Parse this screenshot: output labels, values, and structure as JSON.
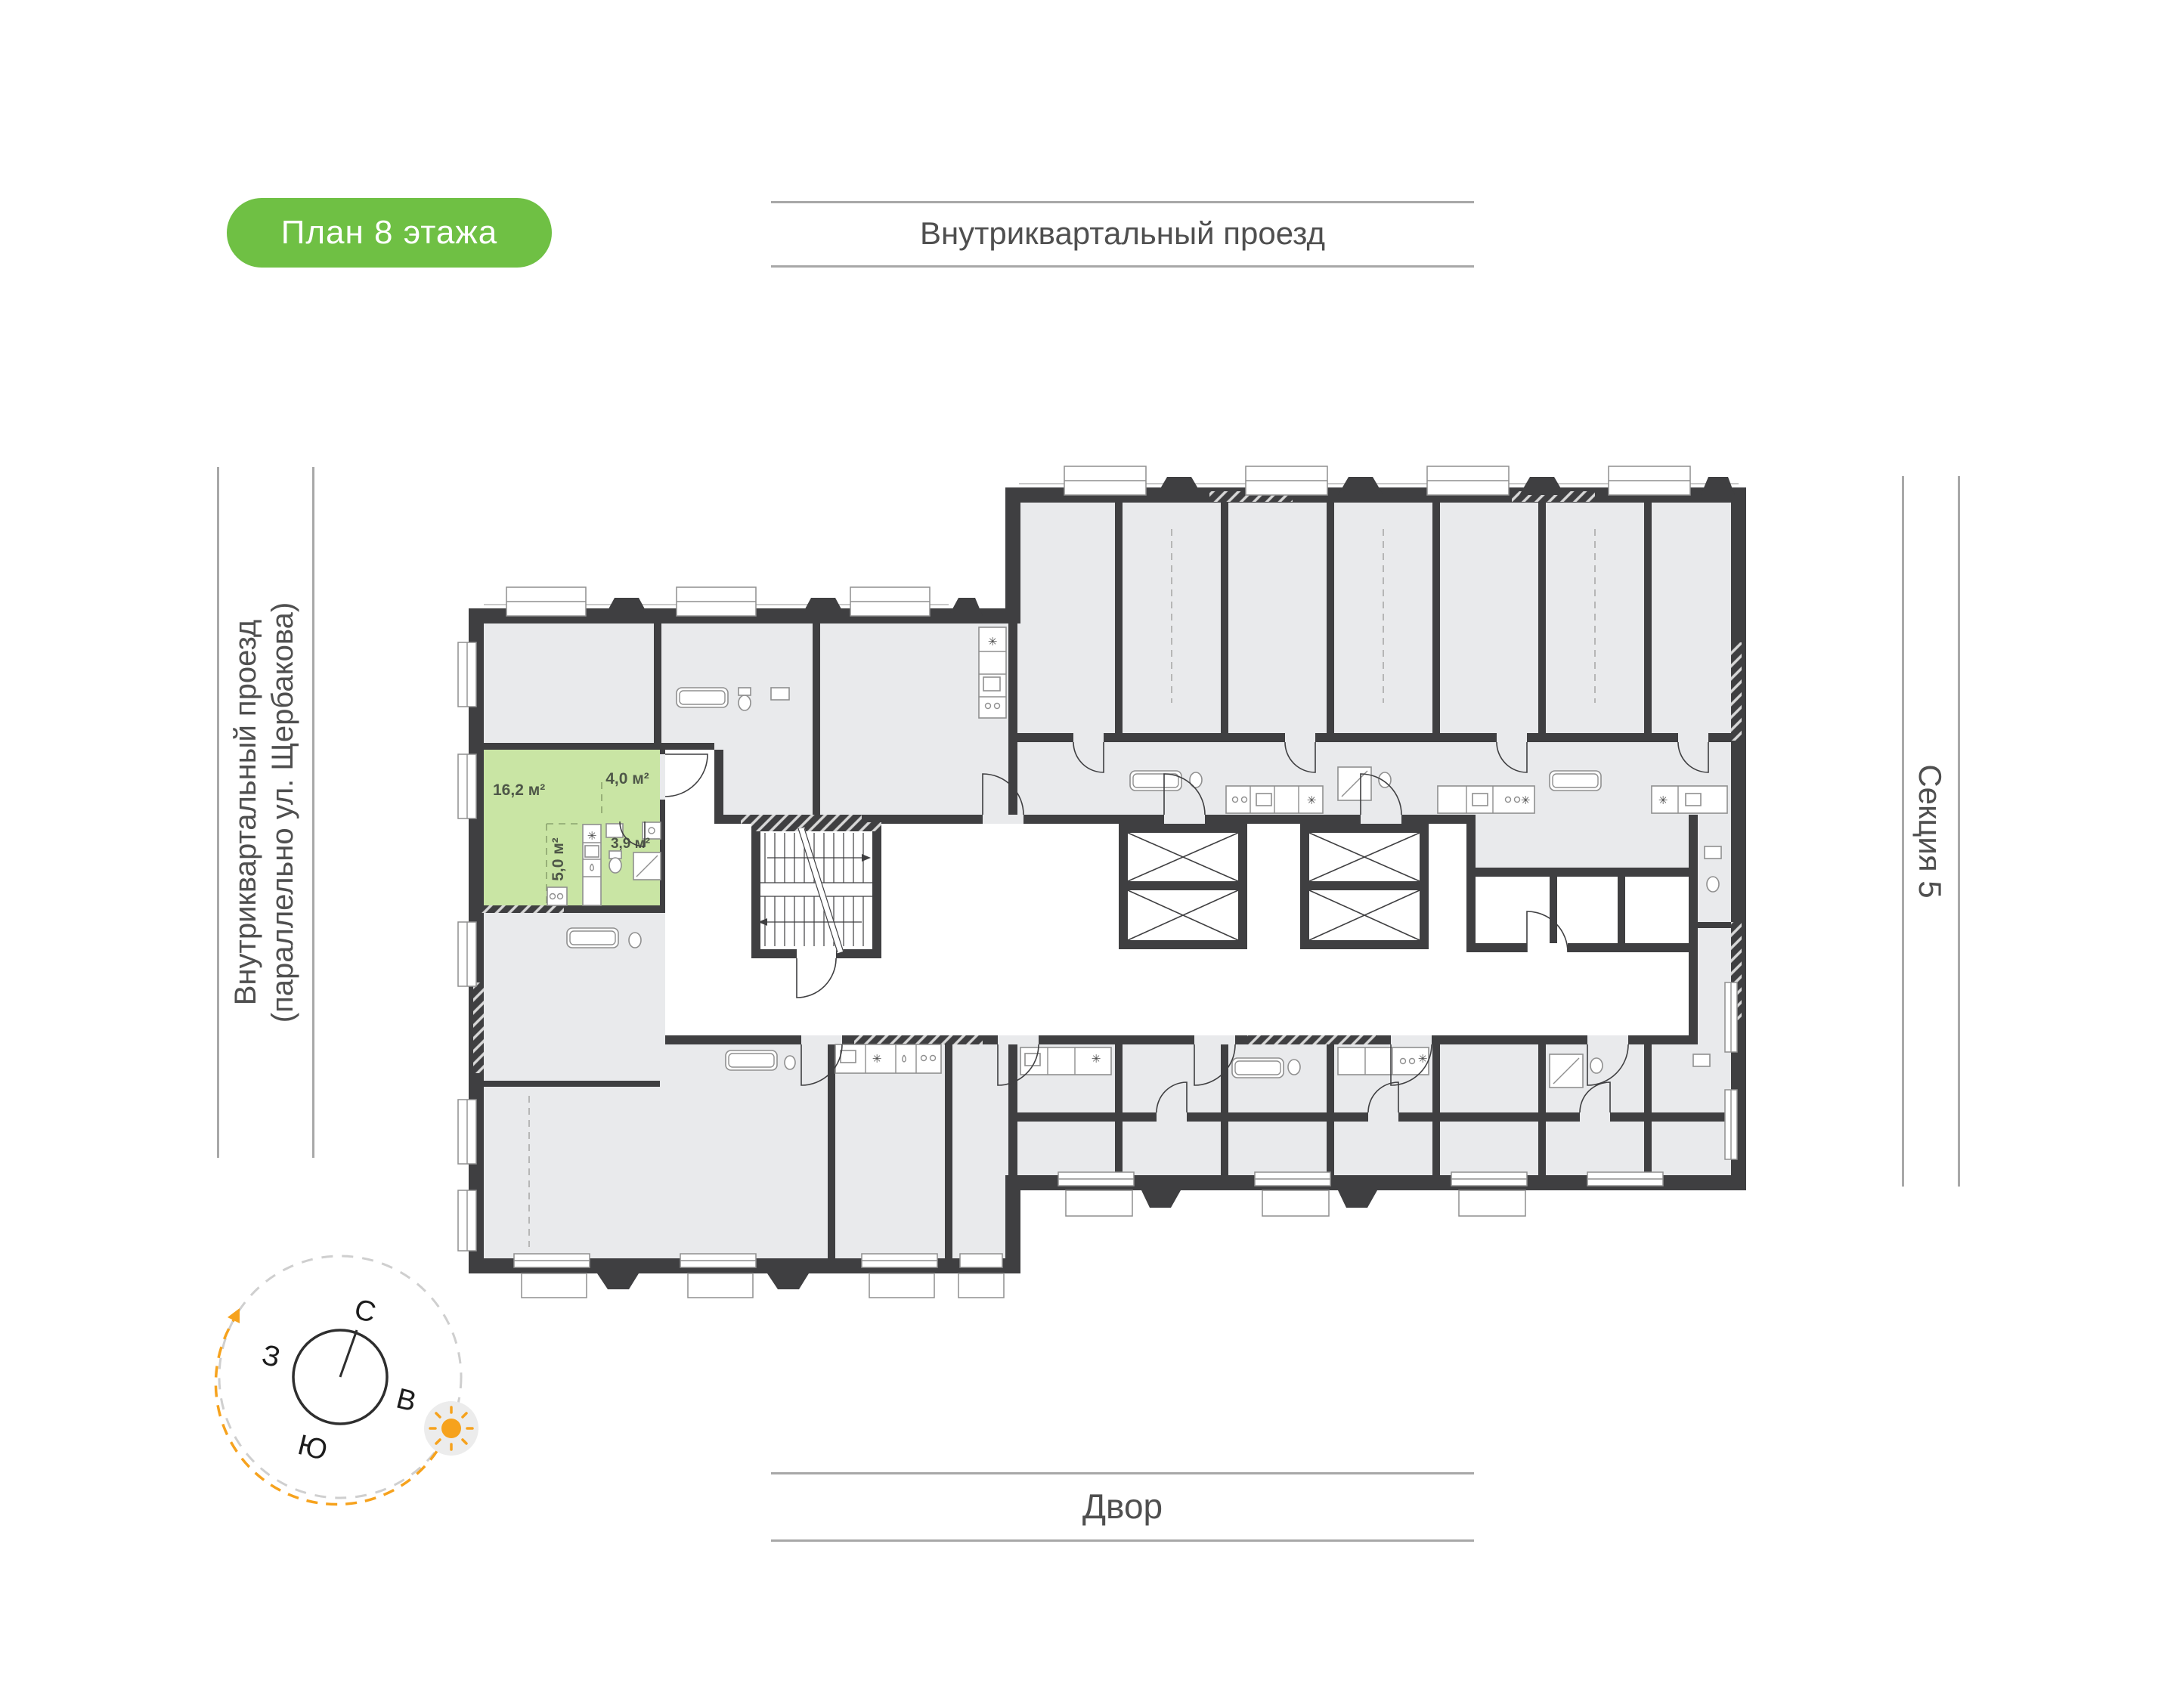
{
  "page": {
    "background": "#ffffff"
  },
  "badge": {
    "label": "План 8 этажа",
    "bg_color": "#6fc044",
    "text_color": "#ffffff"
  },
  "roads": {
    "top": "Внутриквартальный проезд",
    "left_line1": "Внутриквартальный проезд",
    "left_line2": "(параллельно ул. Щербакова)",
    "section": "Секция 5",
    "bottom": "Двор"
  },
  "compass": {
    "north": "С",
    "south": "Ю",
    "west": "З",
    "east": "В",
    "needle_color": "#2e2e2e",
    "sun_color": "#f6a21d",
    "arc_color": "#f6a21d",
    "dash_color": "#cfcfcf"
  },
  "apartment": {
    "highlight_color": "#c9e5a4",
    "label_color": "#4e5748",
    "room_area": "16,2 м²",
    "hall_area": "4,0 м²",
    "kitchen_area": "5,0 м²",
    "bath_area": "3,9 м²"
  },
  "plan": {
    "wall_color": "#3f3f41",
    "room_fill": "#e9eaec",
    "corridor_fill": "#ffffff",
    "vent_symbol": "✳",
    "line_color": "#a8a8a8",
    "label_color": "#4f4f4f"
  }
}
